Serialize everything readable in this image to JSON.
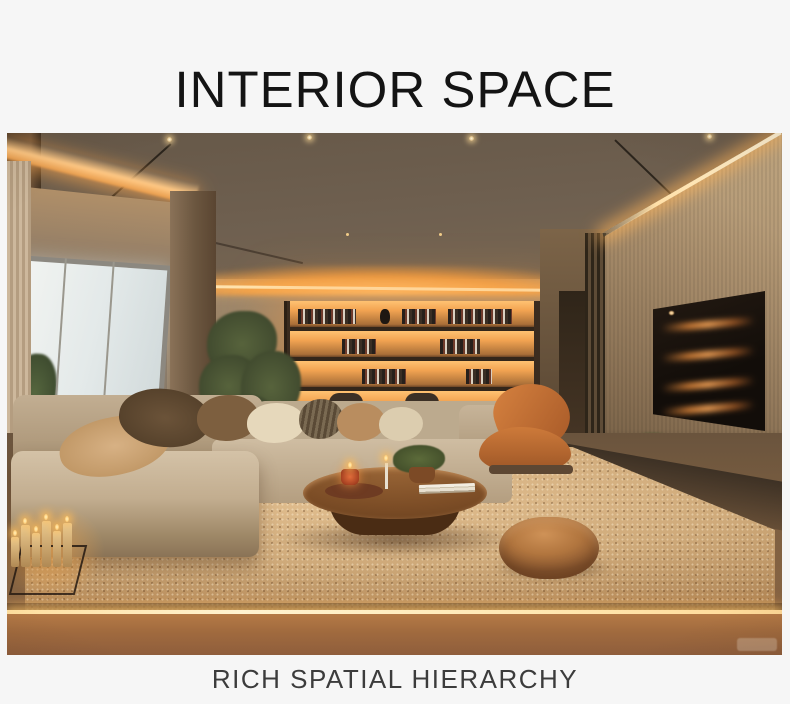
{
  "page": {
    "title": "INTERIOR SPACE",
    "caption": "RICH SPATIAL HIERARCHY",
    "background": "#f6f6f6",
    "title_color": "#141414",
    "caption_color": "#3c3c3c"
  },
  "photo": {
    "alt": "Warmly lit modern living room: backlit four-shelf display wall, L-shaped beige sectional sofa with pillows, round wooden coffee table with candles and plant, terracotta lounge chair, leather pouf on speckled rug, wall-mounted TV on wood-slat wall with glowing media console, floor-to-ceiling window with sheer curtain, indoor tree, cluster of lit candles and floor LED strip",
    "colors": {
      "ceiling": "#6e5f4f",
      "cove_glow": "#ffb35c",
      "wall": "#8d7964",
      "shelf_light": "#f3a452",
      "sofa": "#c6b299",
      "accent_chair": "#c47038",
      "rug": "#c39a6c",
      "floor": "#9c6336",
      "window_light": "#e8edec"
    }
  }
}
